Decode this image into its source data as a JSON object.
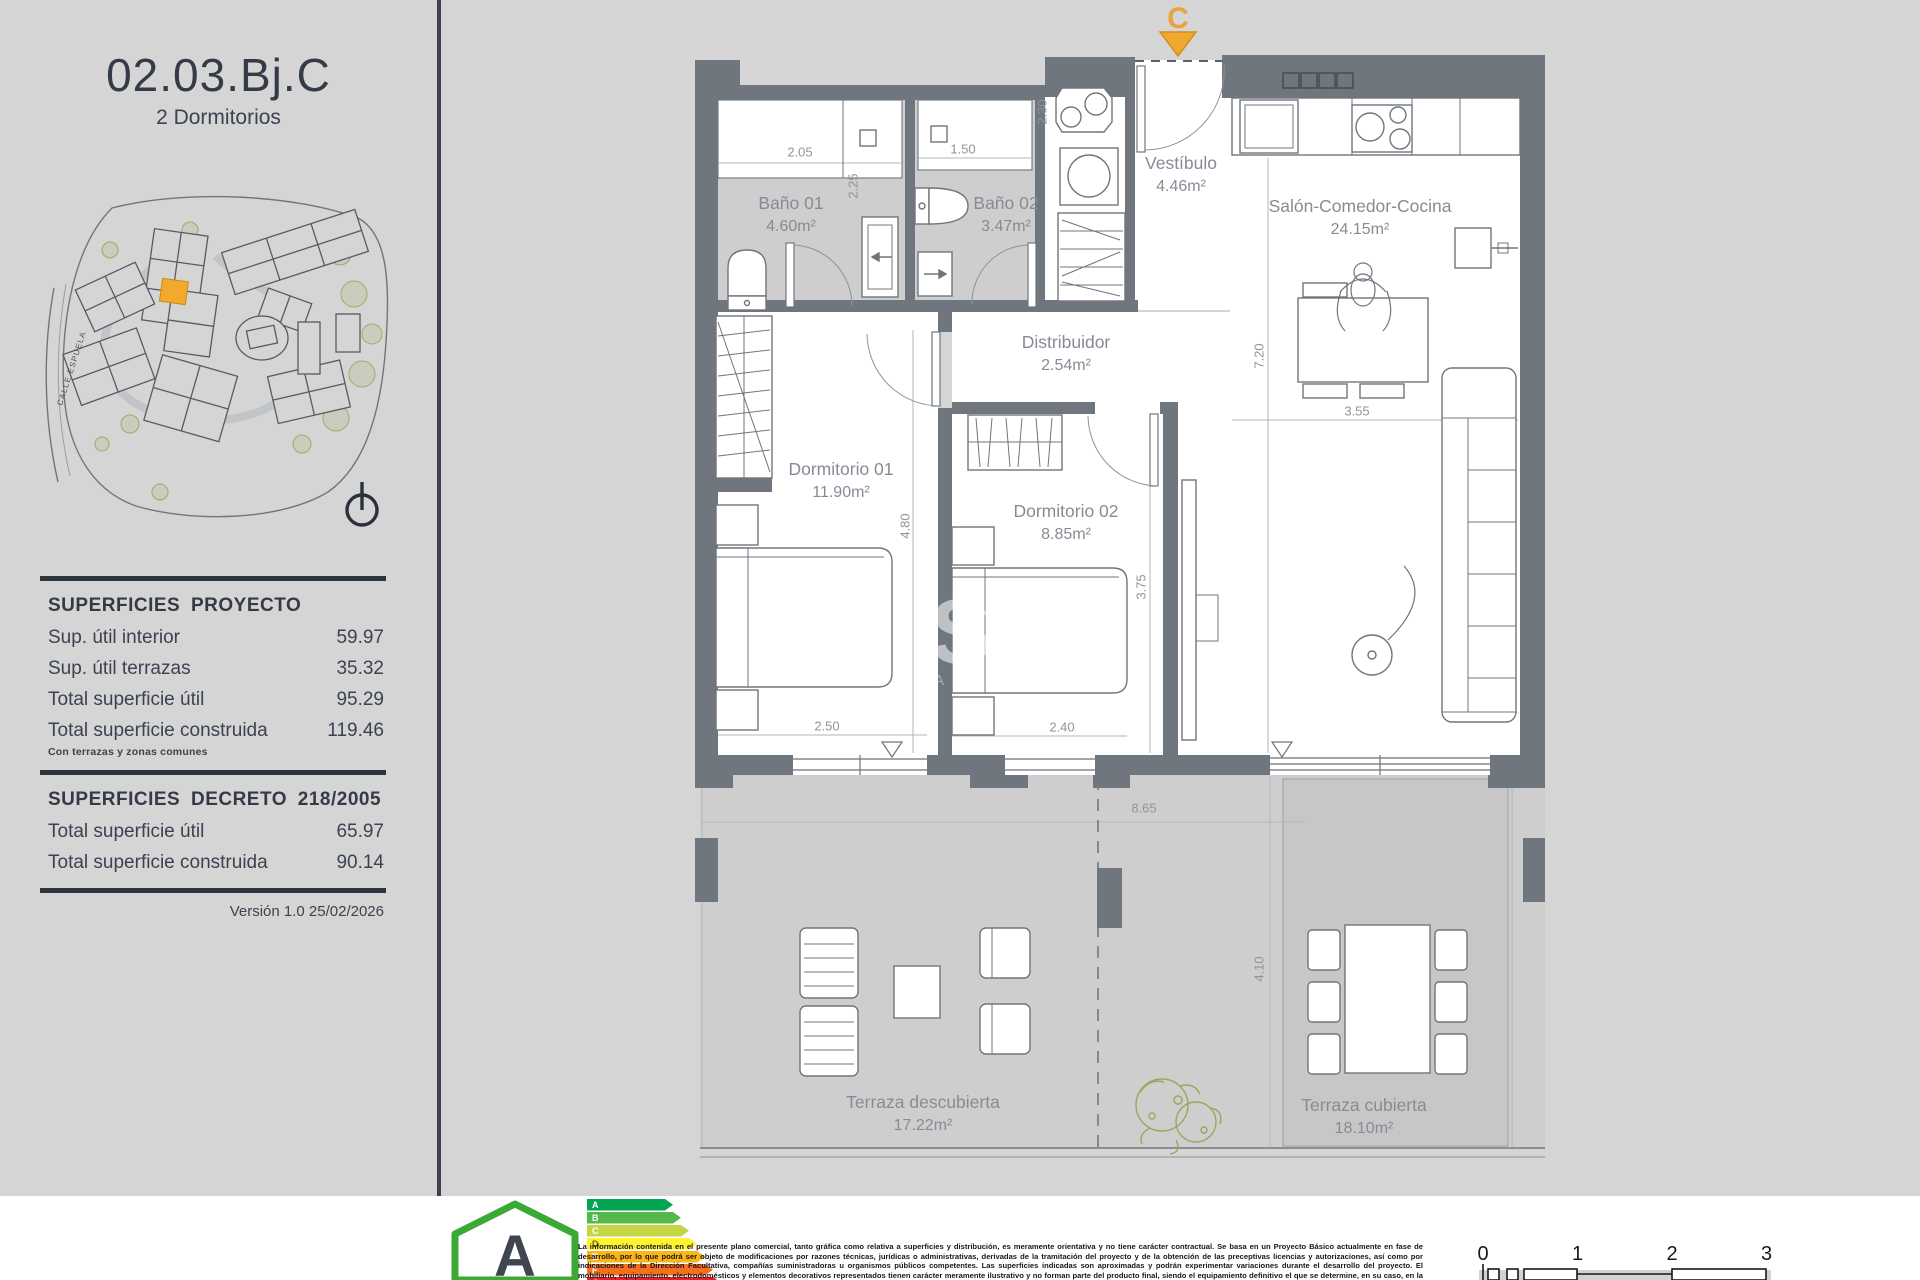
{
  "sidebar": {
    "title": "02.03.Bj.C",
    "subtitle": "2 Dormitorios",
    "map": {
      "street": "CALLE ESPUELA"
    },
    "table1": {
      "header": "SUPERFICIES PROYECTO",
      "rows": [
        {
          "label": "Sup. útil interior",
          "value": "59.97"
        },
        {
          "label": "Sup. útil terrazas",
          "value": "35.32"
        },
        {
          "label": "Total superficie útil",
          "value": "95.29"
        },
        {
          "label": "Total superficie construida",
          "value": "119.46"
        }
      ],
      "note": "Con terrazas y zonas comunes"
    },
    "table2": {
      "header": "SUPERFICIES DECRETO 218/2005",
      "rows": [
        {
          "label": "Total superficie útil",
          "value": "65.97"
        },
        {
          "label": "Total superficie construida",
          "value": "90.14"
        }
      ]
    },
    "version": "Versión 1.0 25/02/2026"
  },
  "plan": {
    "entry_marker": "C",
    "watermark_big": "S",
    "watermark_small": "A R",
    "rooms": [
      {
        "name": "Baño 01",
        "area": "4.60m²"
      },
      {
        "name": "Baño 02",
        "area": "3.47m²"
      },
      {
        "name": "Vestíbulo",
        "area": "4.46m²"
      },
      {
        "name": "Salón-Comedor-Cocina",
        "area": "24.15m²"
      },
      {
        "name": "Distribuidor",
        "area": "2.54m²"
      },
      {
        "name": "Dormitorio 01",
        "area": "11.90m²"
      },
      {
        "name": "Dormitorio 02",
        "area": "8.85m²"
      },
      {
        "name": "Terraza descubierta",
        "area": "17.22m²"
      },
      {
        "name": "Terraza cubierta",
        "area": "18.10m²"
      }
    ],
    "dims": [
      "2.05",
      "1.50",
      "2.30",
      "2.25",
      "7.20",
      "3.55",
      "4.80",
      "3.75",
      "2.50",
      "2.40",
      "8.65",
      "4.10"
    ]
  },
  "footer": {
    "energy": {
      "rating": "A",
      "bands": [
        "A",
        "B",
        "C",
        "D",
        "E",
        "F",
        "G"
      ]
    },
    "scale_ticks": [
      "0",
      "1",
      "2",
      "3"
    ],
    "disclaimer": "La información contenida en el presente plano comercial, tanto gráfica como relativa a superficies y distribución, es meramente orientativa y no tiene carácter contractual. Se basa en un Proyecto Básico actualmente en fase de desarrollo, por lo que podrá ser objeto de modificaciones por razones técnicas, jurídicas o administrativas, derivadas de la tramitación del proyecto y de la obtención de las preceptivas licencias y autorizaciones, así como por indicaciones de la Dirección Facultativa, compañías suministradoras u organismos públicos competentes. Las superficies indicadas son aproximadas y podrán experimentar variaciones durante el desarrollo del proyecto. El mobiliario, equipamiento, electrodomésticos y elementos decorativos representados tienen carácter meramente ilustrativo y no forman parte del producto final, siendo el equipamiento definitivo el que se determine, en su caso, en la correspondiente memoria de calidades."
  },
  "colors": {
    "accent_orange": "#F0A830",
    "wall_gray": "#70767D",
    "energy_green": "#3AAA35"
  }
}
